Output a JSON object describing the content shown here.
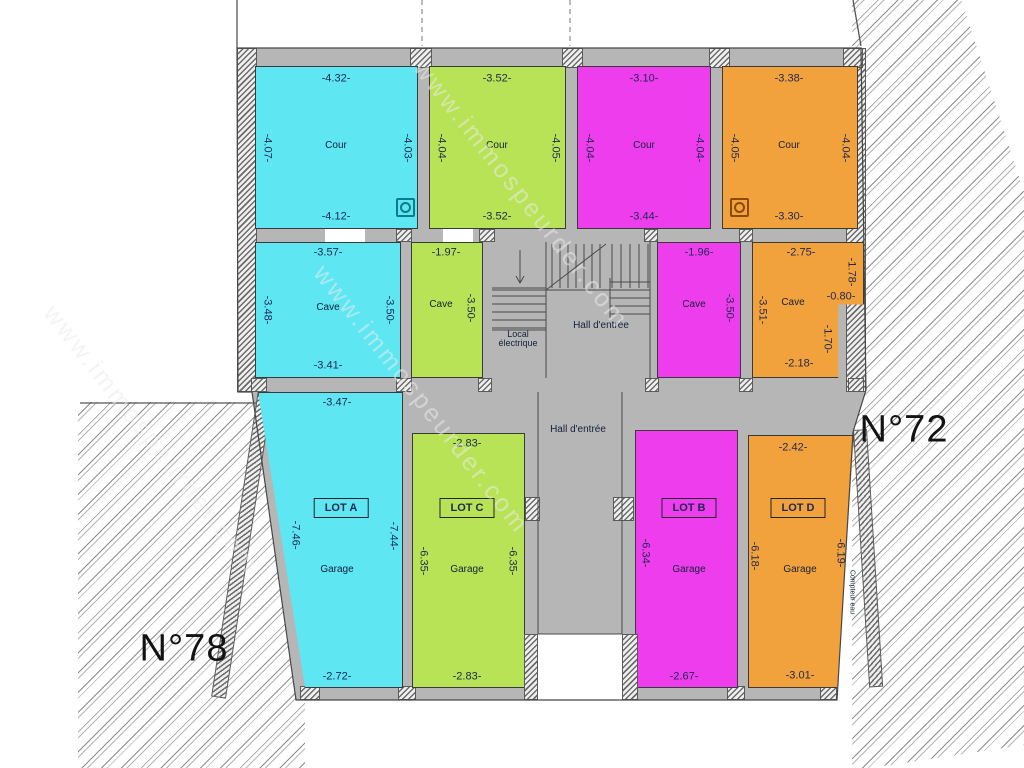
{
  "parcels": {
    "left": "N°78",
    "right": "N°72"
  },
  "watermark": "www.immospeurder.com",
  "icons": {
    "cour_cyan": "drain-icon",
    "cour_orange": "drain-icon"
  },
  "rooms": {
    "cour_cyan": {
      "label": "Cour",
      "top": "-4.32-",
      "left": "-4.07-",
      "right": "-4.03-",
      "bottom": "-4.12-"
    },
    "cour_green": {
      "label": "Cour",
      "top": "-3.52-",
      "left": "-4.04-",
      "right": "-4.05-",
      "bottom": "-3.52-"
    },
    "cour_magenta": {
      "label": "Cour",
      "top": "-3.10-",
      "left": "-4.04-",
      "right": "-4.04-",
      "bottom": "-3.44-"
    },
    "cour_orange": {
      "label": "Cour",
      "top": "-3.38-",
      "left": "-4.05-",
      "right": "-4.04-",
      "bottom": "-3.30-"
    },
    "cave_cyan": {
      "label": "Cave",
      "top": "-3.57-",
      "left": "-3.48-",
      "right": "-3.50-",
      "bottom": "-3.41-"
    },
    "cave_green": {
      "label": "Cave",
      "top": "-1.97-",
      "right": "-3.50-"
    },
    "cave_magenta": {
      "label": "Cave",
      "top": "-1.96-",
      "right": "-3.50-"
    },
    "cave_orange": {
      "label": "Cave",
      "top": "-2.75-",
      "left": "-3.51-",
      "right_upper": "-1.78-",
      "step": "-0.80-",
      "right_lower": "-1.70-",
      "bottom": "-2.18-"
    },
    "local_electrique": {
      "line1": "Local",
      "line2": "électrique"
    },
    "hall_upper": {
      "label": "Hall d'entrée"
    },
    "hall_lower": {
      "label": "Hall d'entrée"
    },
    "garage_a": {
      "lot": "LOT A",
      "label": "Garage",
      "top": "-3.47-",
      "left": "-7.46-",
      "right": "-7.44-",
      "bottom": "-2.72-"
    },
    "garage_c": {
      "lot": "LOT C",
      "label": "Garage",
      "top": "-2.83-",
      "left": "-6.35-",
      "right": "-6.35-",
      "bottom": "-2.83-"
    },
    "garage_b": {
      "lot": "LOT B",
      "label": "Garage",
      "left": "-6.34-",
      "bottom": "-2.67-"
    },
    "garage_d": {
      "lot": "LOT D",
      "label": "Garage",
      "top": "-2.42-",
      "left": "-6.18-",
      "right": "-6.19-",
      "bottom": "-3.01-",
      "meter": "Compteur eau"
    }
  },
  "colors": {
    "cyan": "#5ee6f2",
    "green": "#b8e356",
    "magenta": "#ee3ded",
    "orange": "#f2a23c",
    "wall_gray": "#b6b6b6"
  }
}
